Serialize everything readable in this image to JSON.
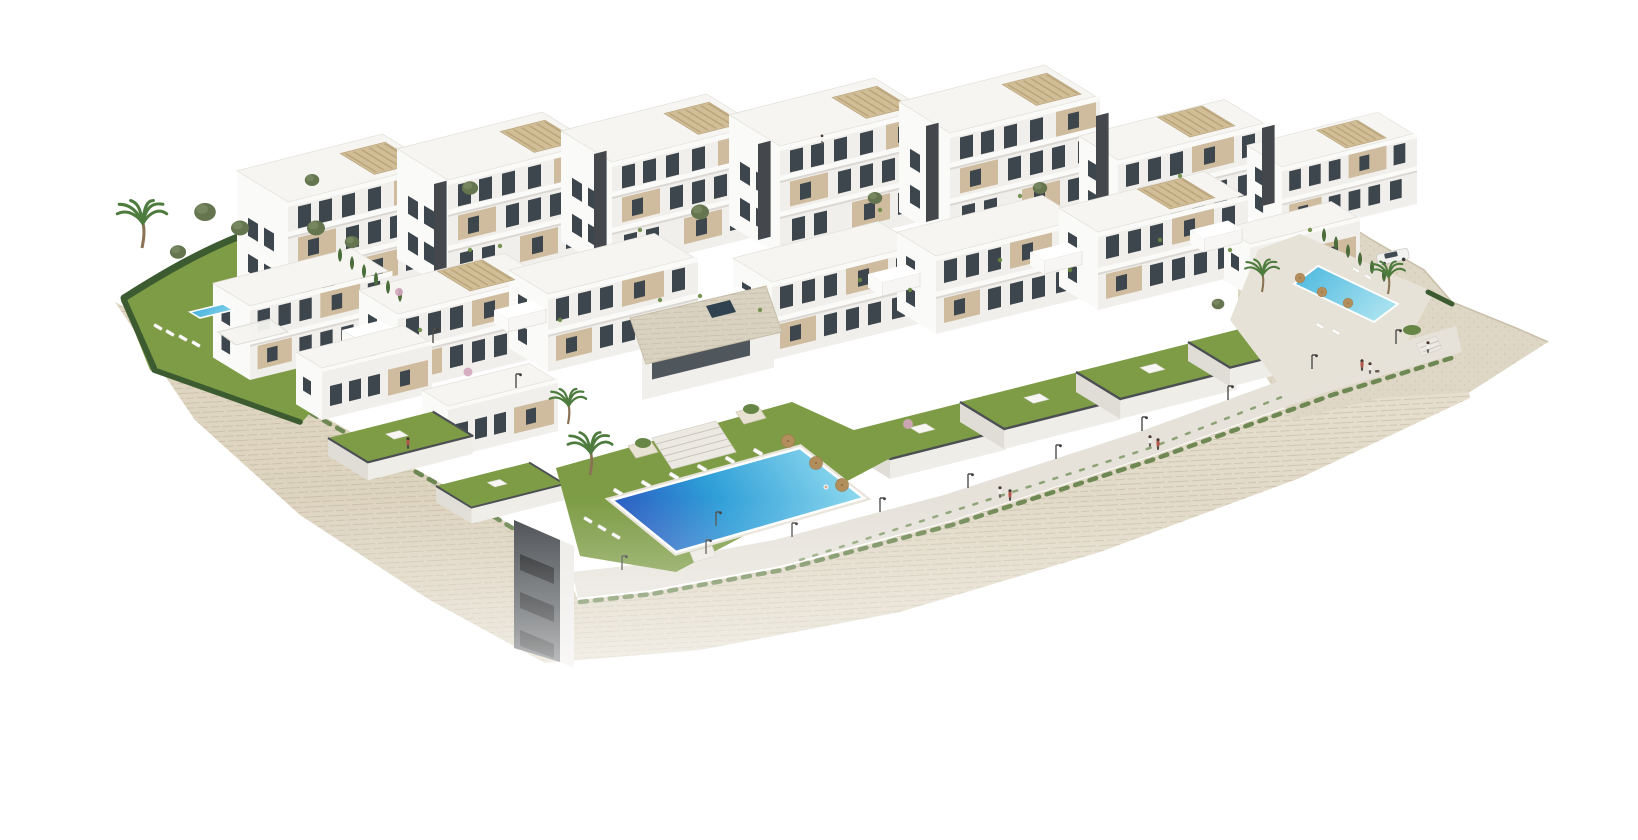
{
  "scene": {
    "type": "3d-architectural-render",
    "elements": {
      "swimming_pools": 3,
      "building_blocks": 14,
      "private_gardens": 8,
      "street_lamps": 13,
      "palm_trees": 5,
      "sun_umbrellas": 6,
      "cars": 1,
      "people": 10,
      "dogs": 1,
      "staircases": 3,
      "rooftop_pergolas": 9
    }
  },
  "colors": {
    "background": "#ffffff",
    "wall_stone": "#e9e2d2",
    "wall_stone_dark": "#ddd4c0",
    "wall_left_face": "#d8cdb8",
    "wall_line": "#b3a88f",
    "promenade": "#e6e2da",
    "gravel": "#ded7c5",
    "lawn": "#7d9c45",
    "lawn_dark": "#6d8b3c",
    "hedge": "#3d5b31",
    "cypress": "#4a6c38",
    "shrub": "#5a7a40",
    "pool_deep": "#2a58c0",
    "pool_mid": "#2f9fd8",
    "pool_light": "#93dcef",
    "pool_small_a": "#37a8d8",
    "pool_small_b": "#7fd0ea",
    "pool_right_a": "#49b7de",
    "pool_right_b": "#a5e0ef",
    "facade": "#f1efec",
    "end_face": "#fafaf8",
    "roof": "#f6f5f2",
    "roof_edge": "#e3e0da",
    "window": "#3e464d",
    "beige_panel": "#cfbc9e",
    "core_dark": "#44484c",
    "pergola": "#cdb88f",
    "slat": "#b19b72",
    "parapet_dark": "#4b4f53",
    "garden_wall": "#efede8",
    "garden_wall_shade": "#e0ddd6",
    "stone_roof": "#d9d2c1",
    "stairs": "#ece9e2",
    "umbrella": "#b28e5d",
    "lounger": "#fcfcfa",
    "lamp": "#4d4d4b",
    "car": "#f2f2f0",
    "person_shirt": "#f0efec",
    "person_accent": "#b5544a"
  }
}
